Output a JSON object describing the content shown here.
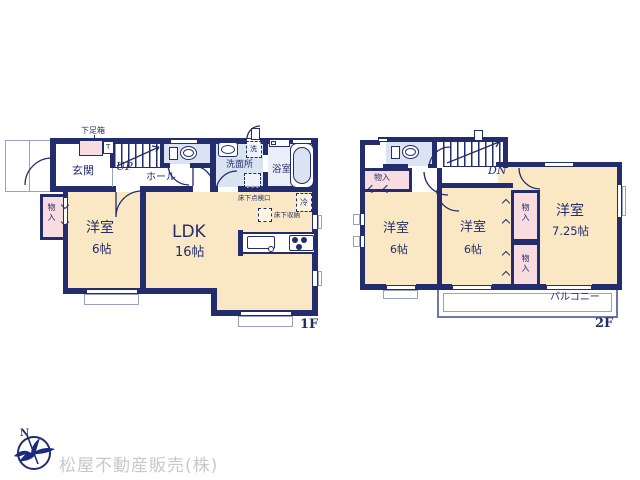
{
  "colors": {
    "wall": "#232c6d",
    "room_fill": "#f9e8c3",
    "closet_fill": "#f8dce0",
    "wet_area_fill": "#d9e3f2",
    "bath_fill": "#e9eef8",
    "company_text": "#c7c7ce"
  },
  "floor1": {
    "label": "1F",
    "entrance": "玄関",
    "shoe_box": "下足箱",
    "shoe_box_mark": "T",
    "stairs_up": "UP",
    "hall": "ホール",
    "washer": "洗",
    "washroom": "洗面所",
    "bath": "浴室",
    "underfloor_hatch": "床下点検口",
    "fridge": "冷",
    "underfloor_storage": "床下収納",
    "closet": "物入",
    "western_room": {
      "name": "洋室",
      "size": "6帖"
    },
    "ldk": {
      "name": "LDK",
      "size": "16帖"
    }
  },
  "floor2": {
    "label": "2F",
    "stairs_down": "DN",
    "closet_top": "物入",
    "closet_upper": "物入",
    "closet_lower": "物入",
    "room_left": {
      "name": "洋室",
      "size": "6帖"
    },
    "room_middle": {
      "name": "洋室",
      "size": "6帖"
    },
    "room_right": {
      "name": "洋室",
      "size": "7.25帖"
    },
    "balcony": "バルコニー"
  },
  "footer": {
    "company": "松屋不動産販売(株)",
    "compass_letter": "N"
  }
}
